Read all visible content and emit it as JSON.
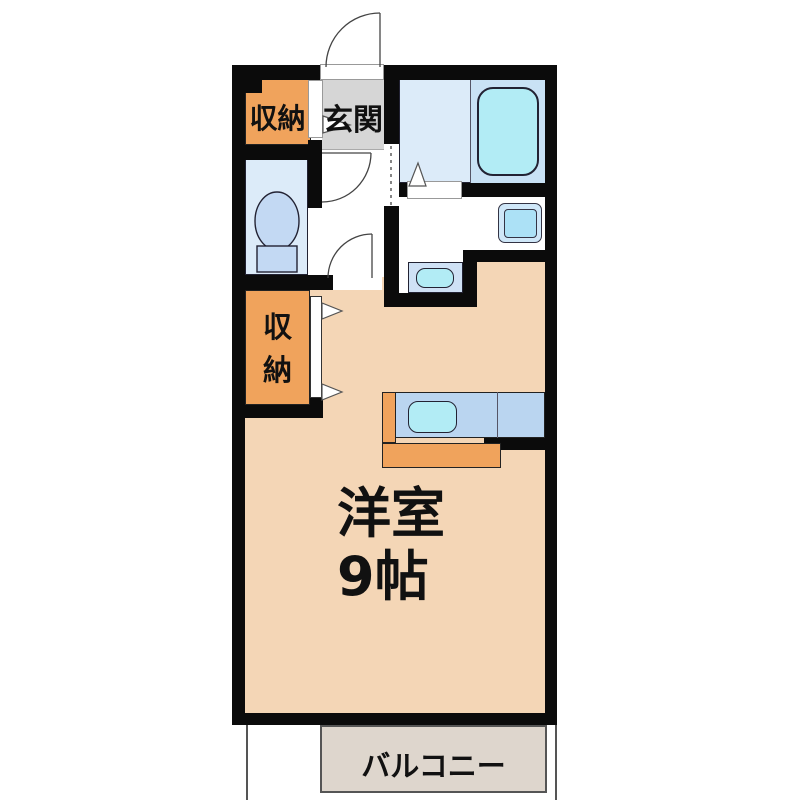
{
  "floorplan": {
    "type": "apartment-floor-plan",
    "rooms": {
      "storage_top": {
        "label": "収納"
      },
      "entrance": {
        "label": "玄関"
      },
      "storage_mid": {
        "label_line1": "収",
        "label_line2": "納"
      },
      "main_room": {
        "label_line1": "洋室",
        "label_line2": "9帖"
      },
      "balcony": {
        "label": "バルコニー"
      }
    },
    "fixtures": [
      "bathtub",
      "toilet",
      "wash-basin",
      "washing-machine-pan",
      "kitchen-sink",
      "kitchen-counter"
    ],
    "colors": {
      "wall": "#0b0b0b",
      "room_peach": "#f4d6b6",
      "storage_orange": "#f0a35c",
      "entrance_gray": "#d6d6d6",
      "room_blue": "#dcebf9",
      "bath_blue": "#c9e2f5",
      "fixture_cyan": "#b2ecf5",
      "counter_blue": "#bad5f0",
      "toilet_blue": "#c3d9f3",
      "washer_outer": "#cfe7f8",
      "washer_inner": "#ace1f6",
      "balcony_gray": "#ded6cd",
      "line": "#444444"
    }
  }
}
